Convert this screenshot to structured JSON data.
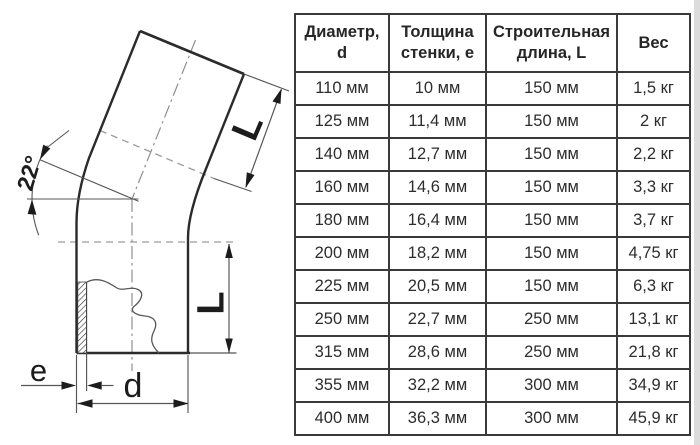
{
  "diagram": {
    "labels": {
      "angle": "22°",
      "length_upper": "L",
      "length_lower": "L",
      "wall_thickness": "e",
      "diameter": "d"
    }
  },
  "table": {
    "headers": [
      "Диаметр,\nd",
      "Толщина\nстенки, е",
      "Строительная\nдлина, L",
      "Вес"
    ],
    "rows": [
      [
        "110 мм",
        "10 мм",
        "150 мм",
        "1,5 кг"
      ],
      [
        "125 мм",
        "11,4 мм",
        "150 мм",
        "2 кг"
      ],
      [
        "140 мм",
        "12,7 мм",
        "150 мм",
        "2,2 кг"
      ],
      [
        "160 мм",
        "14,6 мм",
        "150 мм",
        "3,3 кг"
      ],
      [
        "180 мм",
        "16,4 мм",
        "150 мм",
        "3,7 кг"
      ],
      [
        "200 мм",
        "18,2 мм",
        "150 мм",
        "4,75 кг"
      ],
      [
        "225 мм",
        "20,5 мм",
        "150 мм",
        "6,3 кг"
      ],
      [
        "250 мм",
        "22,7 мм",
        "250 мм",
        "13,1 кг"
      ],
      [
        "315 мм",
        "28,6 мм",
        "250 мм",
        "21,8 кг"
      ],
      [
        "355 мм",
        "32,2 мм",
        "300 мм",
        "34,9 кг"
      ],
      [
        "400 мм",
        "36,3 мм",
        "300 мм",
        "45,9 кг"
      ]
    ]
  },
  "colors": {
    "outline": "#2b2b2b",
    "thin_line": "#565656",
    "centerline": "#8f8f8f",
    "table_border": "#3a3a3a",
    "text": "#2d2d2d"
  }
}
